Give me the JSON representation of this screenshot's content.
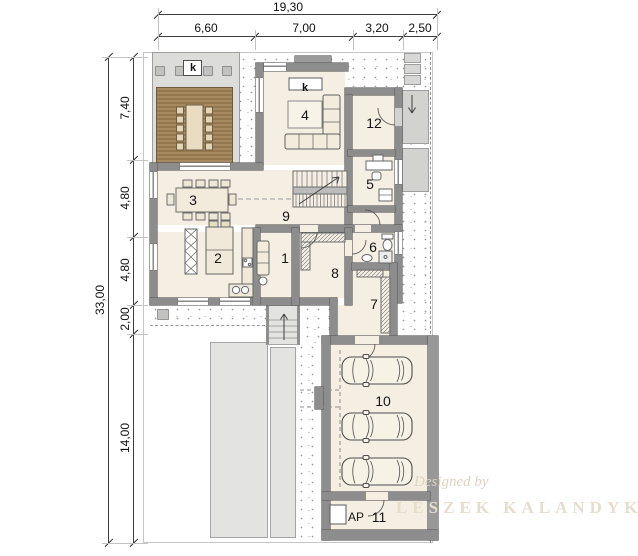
{
  "drawing": {
    "dims_top": {
      "total": "19,30",
      "segments": [
        "6,60",
        "7,00",
        "3,20",
        "2,50"
      ]
    },
    "dims_left": {
      "total": "33,00",
      "segments": [
        "7,40",
        "4,80",
        "4,80",
        "2,00",
        "14,00"
      ]
    },
    "room_numbers": {
      "r1": "1",
      "r2": "2",
      "r3": "3",
      "r4": "4",
      "r5": "5",
      "r6": "6",
      "r7": "7",
      "r8": "8",
      "r9": "9",
      "r10": "10",
      "r11": "11",
      "r12": "12"
    },
    "marks": {
      "chimney_terrace": "k",
      "fireplace": "k",
      "garage_store": "AP"
    },
    "watermark": {
      "line1": "Designed by",
      "line2": "LESZEK KALANDYK"
    },
    "colors": {
      "wall": "#8d8d8d",
      "floor": "#f5efe3",
      "deck": "#a78a60",
      "paving": "#d7d7d6",
      "driveway": "#e3e3e2"
    }
  }
}
